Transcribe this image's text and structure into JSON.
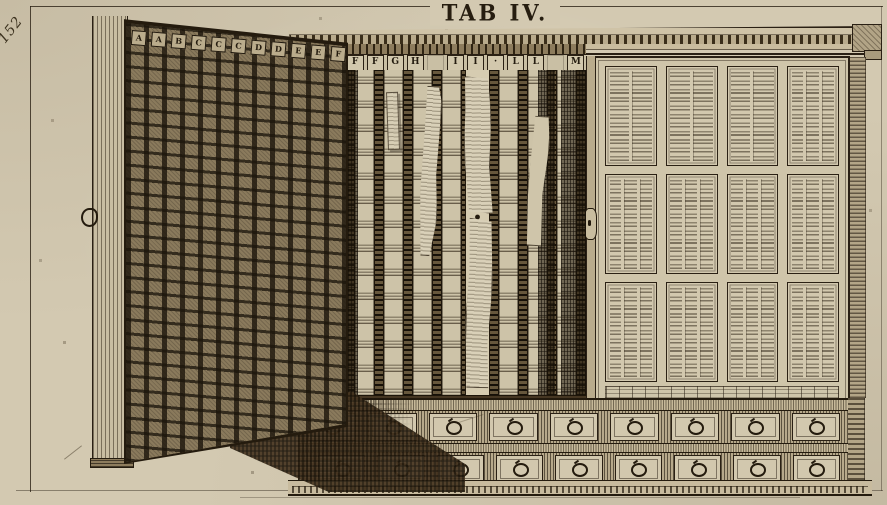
{
  "plate": {
    "title": "TAB IV.",
    "page_number": "152"
  },
  "cabinet": {
    "open_door_letters": [
      "A",
      "A",
      "B",
      "C",
      "C",
      "C",
      "D",
      "D",
      "E",
      "E",
      "F"
    ],
    "shelf_letters": [
      "F",
      "F",
      "G",
      "H",
      "",
      "I",
      "I",
      "·",
      "L",
      "L",
      "",
      "M"
    ],
    "interior_columns": 17,
    "right_door_panels": 12,
    "drawer_rows": 2,
    "drawers_per_row": 9
  },
  "icons": {
    "drawer_pull": "ring-pull",
    "door_handle": "ring-handle",
    "lock": "keyhole"
  },
  "colors": {
    "paper": "#d3c9b1",
    "ink": "#2a2014",
    "door_wood": "#8a7a5c",
    "shadow": "#473621"
  }
}
